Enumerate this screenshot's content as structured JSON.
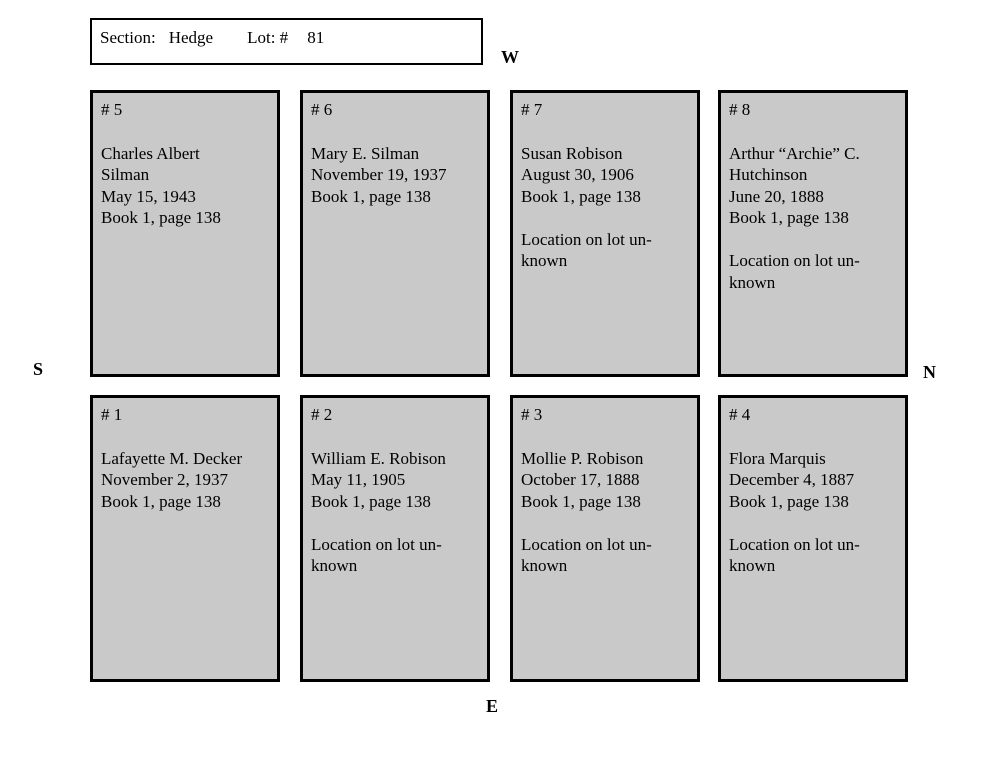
{
  "header": {
    "section_label": "Section:",
    "section_value": "Hedge",
    "lot_label": "Lot: #",
    "lot_value": "81"
  },
  "compass": {
    "west": "W",
    "south": "S",
    "north": "N",
    "east": "E"
  },
  "colors": {
    "plot_fill": "#c9c9c9",
    "plot_border": "#000000",
    "page_background": "#ffffff"
  },
  "rows": [
    {
      "plots": [
        {
          "number": "# 5",
          "body": "Charles Albert\nSilman\nMay 15, 1943\nBook 1, page 138"
        },
        {
          "number": "# 6",
          "body": "Mary E. Silman\nNovember 19, 1937\nBook 1, page 138"
        },
        {
          "number": "# 7",
          "body": "Susan Robison\nAugust 30, 1906\nBook 1, page 138\n\nLocation on lot un-\nknown"
        },
        {
          "number": "# 8",
          "body": "Arthur “Archie” C.\nHutchinson\nJune 20, 1888\nBook 1, page 138\n\nLocation on lot un-\nknown"
        }
      ]
    },
    {
      "plots": [
        {
          "number": "# 1",
          "body": "Lafayette M. Decker\nNovember 2, 1937\nBook 1, page 138"
        },
        {
          "number": "# 2",
          "body": "William E. Robison\nMay 11, 1905\nBook 1, page 138\n\nLocation on lot un-\nknown"
        },
        {
          "number": "# 3",
          "body": "Mollie P. Robison\nOctober 17, 1888\nBook 1, page 138\n\nLocation on lot un-\nknown"
        },
        {
          "number": "# 4",
          "body": "Flora Marquis\nDecember 4, 1887\nBook 1, page 138\n\nLocation on lot un-\nknown"
        }
      ]
    }
  ]
}
